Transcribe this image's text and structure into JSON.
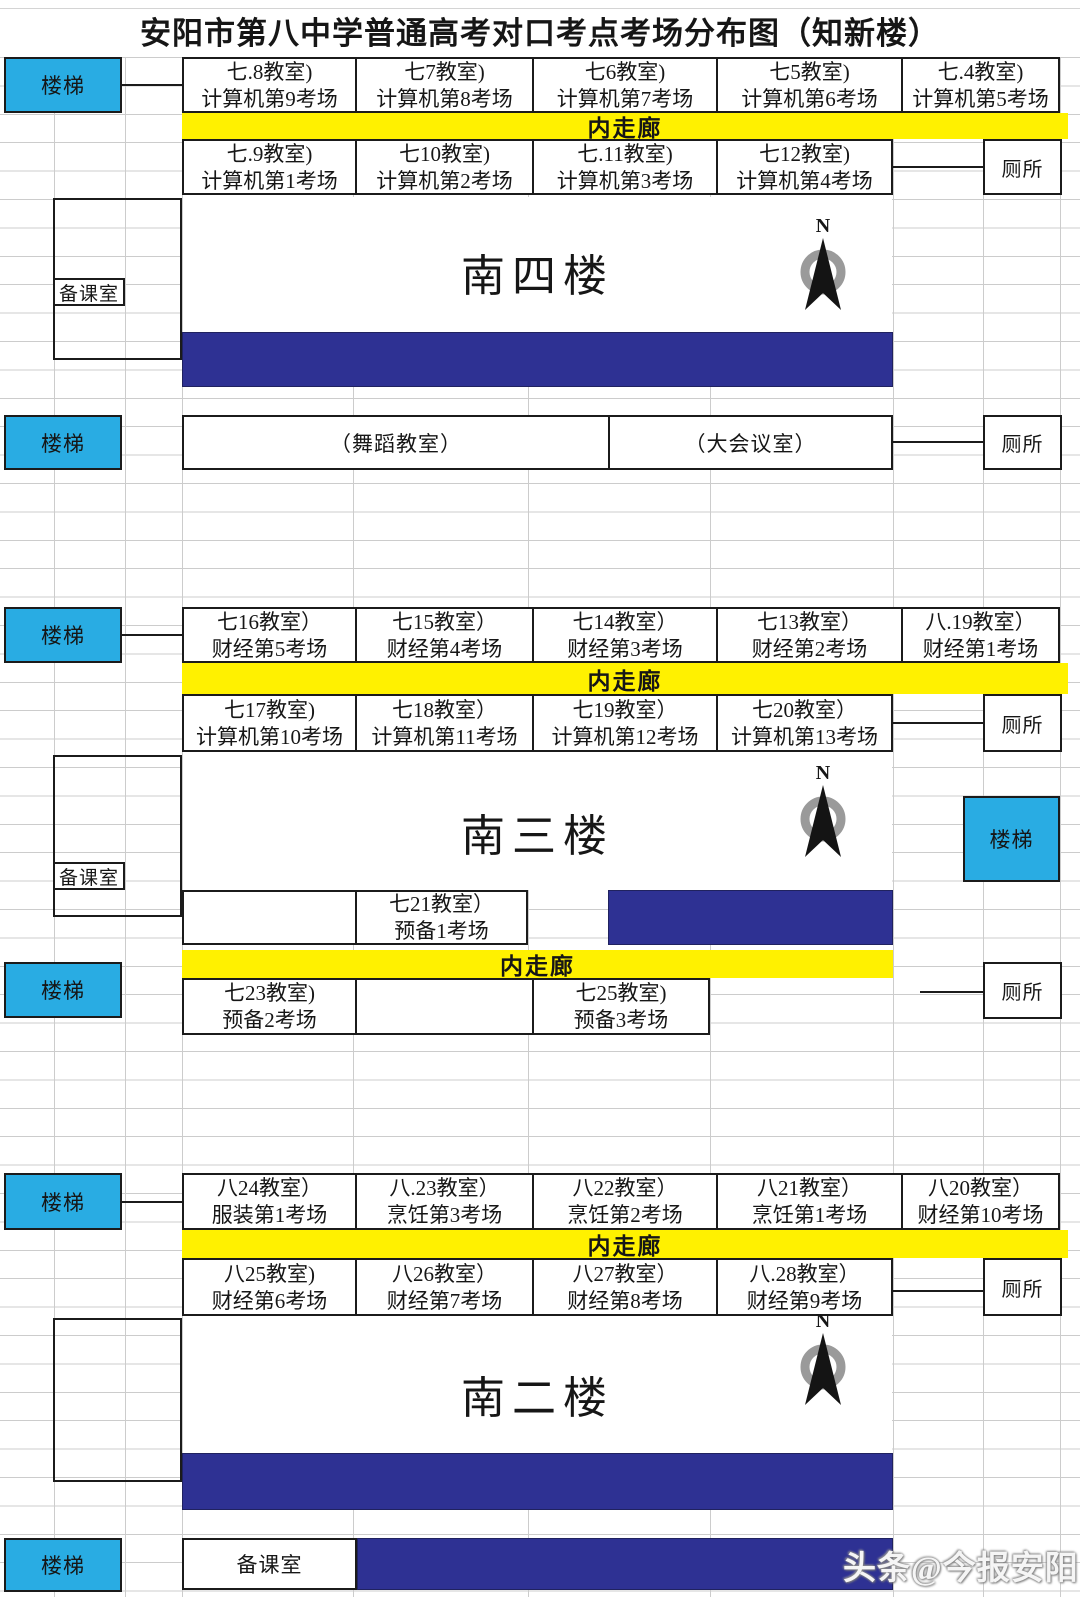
{
  "title": "安阳市第八中学普通高考对口考点考场分布图（知新楼）",
  "common": {
    "stairs": "楼梯",
    "toilet": "厕所",
    "prep_room": "备课室",
    "corridor": "内走廊",
    "compass": "N"
  },
  "colors": {
    "stairs_cyan": "#29ace3",
    "corridor_yellow": "#fff100",
    "bar_navy": "#2e3193"
  },
  "floor4": {
    "name": "南四楼",
    "top": [
      {
        "room": "七.8教室)",
        "exam": "计算机第9考场"
      },
      {
        "room": "七7教室)",
        "exam": "计算机第8考场"
      },
      {
        "room": "七6教室)",
        "exam": "计算机第7考场"
      },
      {
        "room": "七5教室)",
        "exam": "计算机第6考场"
      },
      {
        "room": "七.4教室)",
        "exam": "计算机第5考场"
      }
    ],
    "bottom": [
      {
        "room": "七.9教室)",
        "exam": "计算机第1考场"
      },
      {
        "room": "七10教室)",
        "exam": "计算机第2考场"
      },
      {
        "room": "七.11教室)",
        "exam": "计算机第3考场"
      },
      {
        "room": "七12教室)",
        "exam": "计算机第4考场"
      }
    ],
    "dance_room": "（舞蹈教室）",
    "meeting_room": "（大会议室）"
  },
  "floor3": {
    "name": "南三楼",
    "top": [
      {
        "room": "七16教室）",
        "exam": "财经第5考场"
      },
      {
        "room": "七15教室）",
        "exam": "财经第4考场"
      },
      {
        "room": "七14教室）",
        "exam": "财经第3考场"
      },
      {
        "room": "七13教室）",
        "exam": "财经第2考场"
      },
      {
        "room": "八.19教室）",
        "exam": "财经第1考场"
      }
    ],
    "bottom": [
      {
        "room": "七17教室)",
        "exam": "计算机第10考场"
      },
      {
        "room": "七18教室）",
        "exam": "计算机第11考场"
      },
      {
        "room": "七19教室）",
        "exam": "计算机第12考场"
      },
      {
        "room": "七20教室）",
        "exam": "计算机第13考场"
      }
    ],
    "annex1": {
      "room": "七21教室）",
      "exam": "预备1考场"
    },
    "annex2": [
      {
        "room": "七23教室)",
        "exam": "预备2考场"
      },
      {
        "room": "七25教室)",
        "exam": "预备3考场"
      }
    ]
  },
  "floor2": {
    "name": "南二楼",
    "top": [
      {
        "room": "八24教室）",
        "exam": "服装第1考场"
      },
      {
        "room": "八.23教室）",
        "exam": "烹饪第3考场"
      },
      {
        "room": "八22教室）",
        "exam": "烹饪第2考场"
      },
      {
        "room": "八21教室）",
        "exam": "烹饪第1考场"
      },
      {
        "room": "八20教室）",
        "exam": "财经第10考场"
      }
    ],
    "bottom": [
      {
        "room": "八25教室)",
        "exam": "财经第6考场"
      },
      {
        "room": "八26教室）",
        "exam": "财经第7考场"
      },
      {
        "room": "八27教室）",
        "exam": "财经第8考场"
      },
      {
        "room": "八.28教室）",
        "exam": "财经第9考场"
      }
    ]
  },
  "watermark": "头条@今报安阳"
}
